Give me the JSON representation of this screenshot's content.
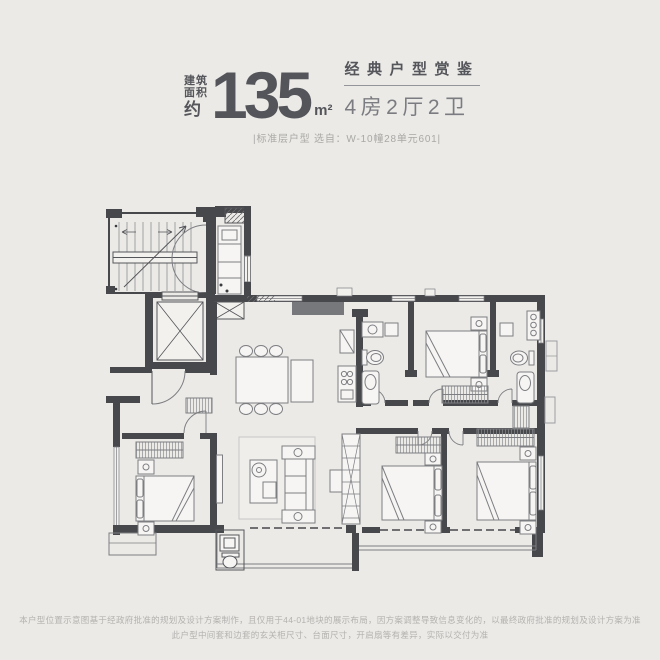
{
  "page": {
    "background_color": "#ebeae7"
  },
  "header": {
    "area_prefix_lines": [
      "建筑",
      "面积",
      "约"
    ],
    "area_value": "135",
    "area_unit": "m²",
    "series_title": "经典户型赏鉴",
    "layout_spec": "4房2厅2卫",
    "caption": "|标准层户型  选自：W-10幢28单元601|",
    "text_color": "#54555a",
    "spec_color": "#7b7c81",
    "caption_color": "#a9a8a5"
  },
  "floorplan": {
    "wall_color": "#47484c",
    "furniture_line_color": "#7d7e82",
    "light_fill_color": "#f4f3f1",
    "rooms": [
      "stairwell",
      "elevator",
      "entry-foyer",
      "kitchen",
      "pipe-shaft",
      "dining-room",
      "living-room",
      "bathroom-1",
      "bathroom-2",
      "bedroom-1",
      "bedroom-2",
      "bedroom-3",
      "bedroom-4",
      "south-balcony",
      "living-balcony",
      "bay-window",
      "utility-wc"
    ]
  },
  "footer": {
    "disclaimer_line1": "本户型位置示意图基于经政府批准的规划及设计方案制作，且仅用于44-01地块的展示布局，因方案调整导致信息变化的，以最终政府批准的规划及设计方案为准",
    "disclaimer_line2": "此户型中间套和边套的玄关柜尺寸、台面尺寸，开启扇等有差异，实际以交付为准",
    "text_color": "#b4b2af"
  }
}
